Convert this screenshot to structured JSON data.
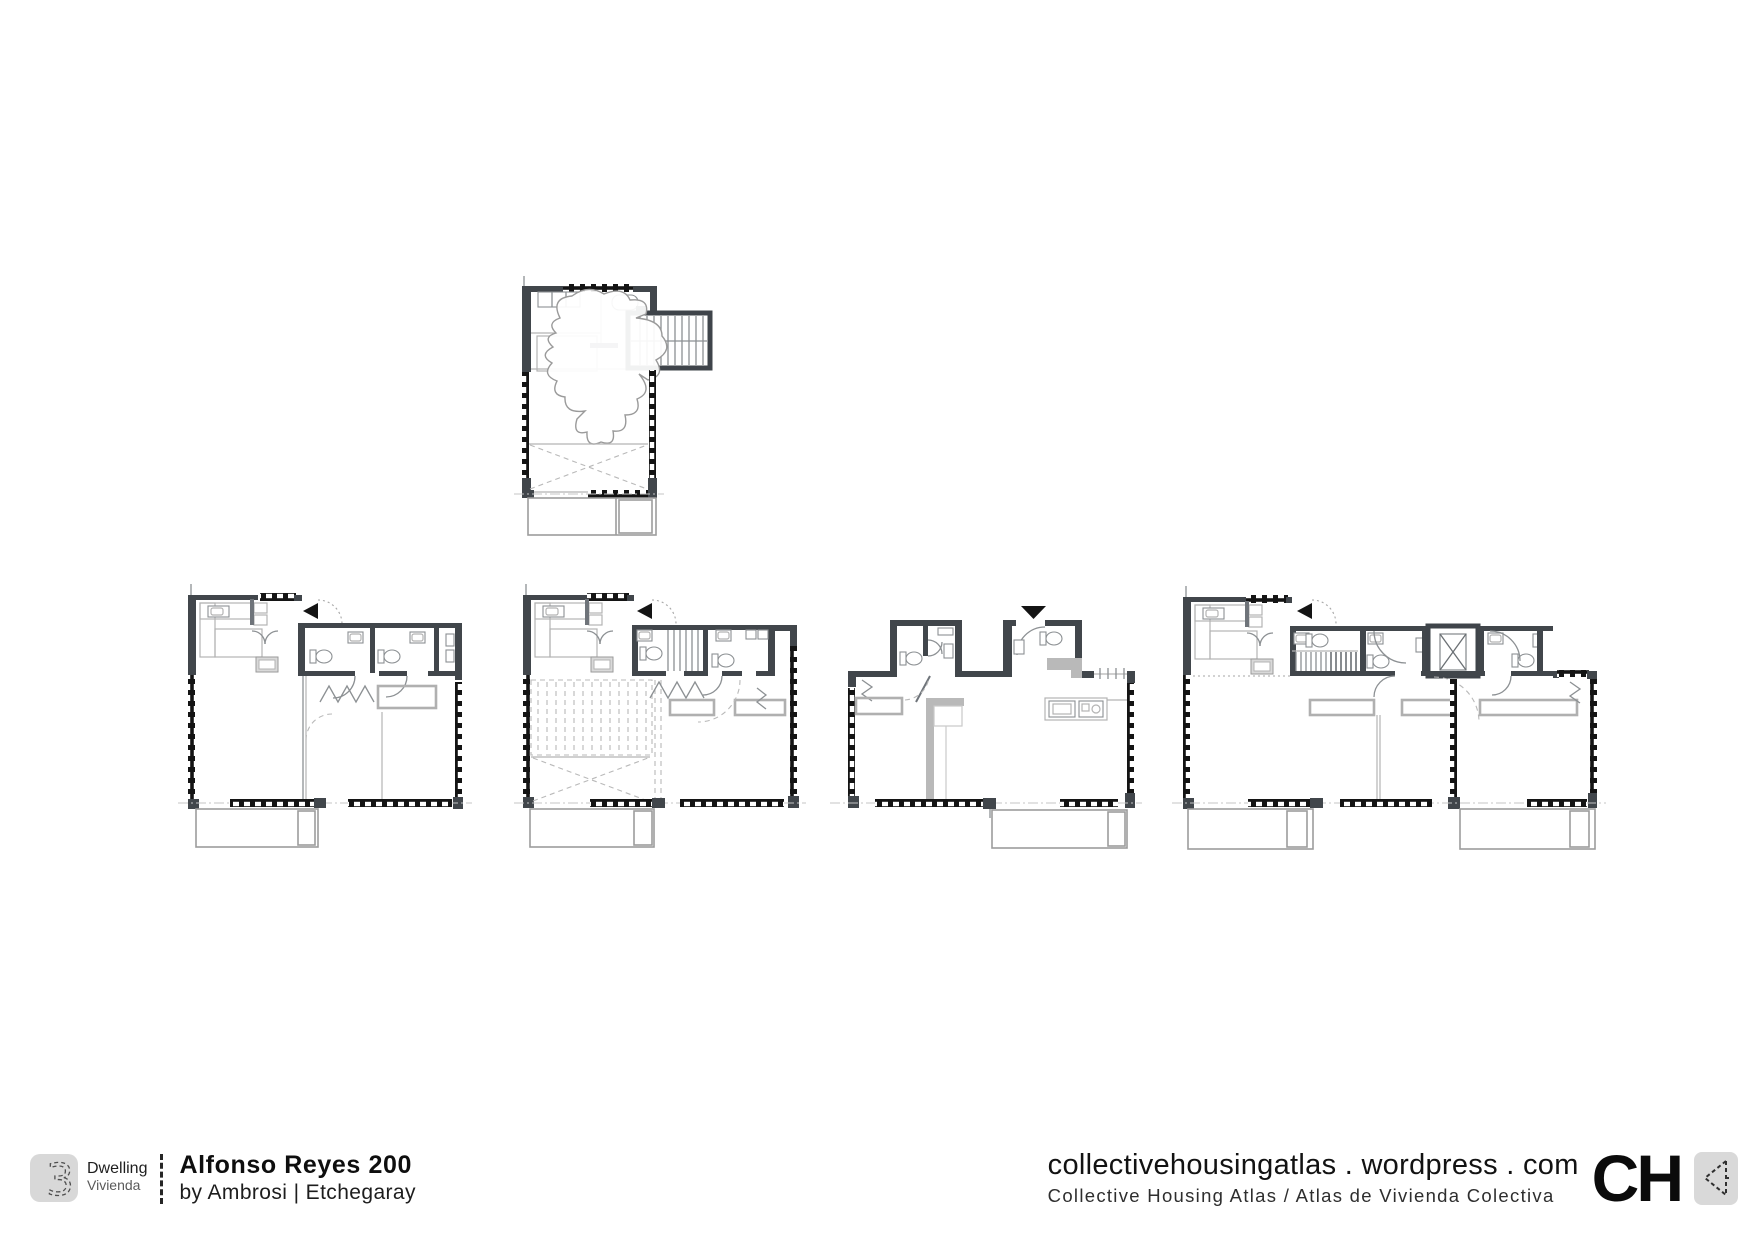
{
  "palette": {
    "background": "#ffffff",
    "wall_dark": "#41464b",
    "line_light": "#b3b3b3",
    "line_mid": "#8c9093",
    "hatch_black": "#141414",
    "marker_black": "#141414",
    "logo_box_gray": "#d8d8d8",
    "text_black": "#161616"
  },
  "icons": {
    "entry_arrow_left": "◀",
    "entry_arrow_down": "▼",
    "atlas_cursor": "◁"
  },
  "footer": {
    "badge_number": "3",
    "badge_label_en": "Dwelling",
    "badge_label_es": "Vivienda",
    "project_title": "Alfonso Reyes 200",
    "project_byline": "by Ambrosi | Etchegaray",
    "site_url": "collectivehousingatlas . wordpress . com",
    "site_tagline": "Collective Housing Atlas / Atlas de Vivienda Colectiva",
    "brand": "CH"
  }
}
